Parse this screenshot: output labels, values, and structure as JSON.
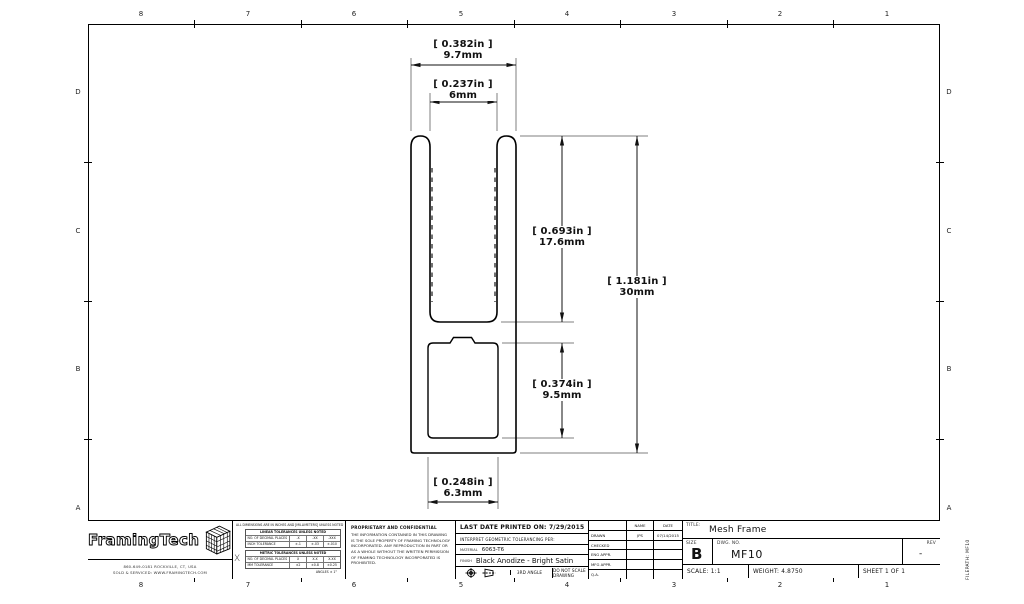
{
  "sheet": {
    "zone_numbers_top": [
      "8",
      "7",
      "6",
      "5",
      "4",
      "3",
      "2",
      "1"
    ],
    "zone_numbers_bottom": [
      "8",
      "7",
      "6",
      "5",
      "4",
      "3",
      "2",
      "1"
    ],
    "zone_letters_left": [
      "D",
      "C",
      "B",
      "A"
    ],
    "zone_letters_right": [
      "D",
      "C",
      "B",
      "A"
    ],
    "filepath_label": "FILEPATH: MF10"
  },
  "dimensions": {
    "outer_width_in": "[ 0.382in ]",
    "outer_width_mm": "9.7mm",
    "slot_width_in": "[ 0.237in ]",
    "slot_width_mm": "6mm",
    "slot_depth_in": "[ 0.693in ]",
    "slot_depth_mm": "17.6mm",
    "overall_height_in": "[ 1.181in ]",
    "overall_height_mm": "30mm",
    "cavity_height_in": "[ 0.374in ]",
    "cavity_height_mm": "9.5mm",
    "cavity_width_in": "[ 0.248in ]",
    "cavity_width_mm": "6.3mm"
  },
  "title_block": {
    "logo_text": "FramingTech",
    "address_line1": "860-649-0181  ROCKVILLE, CT, USA",
    "address_line2": "SOLD & SERVICED:  WWW.FRAMINGTECH.COM",
    "tol": {
      "note": "ALL DIMENSIONS ARE IN INCHES AND [MILLIMETERS] UNLESS NOTED",
      "t1_header": "LINEAR TOLERANCES UNLESS NOTED",
      "t1_r1c1": "NO. OF DECIMAL PLACES",
      "t1_r1c2": ".X",
      "t1_r1c3": ".XX",
      "t1_r1c4": ".XXX",
      "t1_r2c1": "INCH TOLERANCE",
      "t1_r2c2": "±.1",
      "t1_r2c3": "±.03",
      "t1_r2c4": "±.010",
      "t2_header": "METRIC TOLERANCES UNLESS NOTED",
      "t2_r1c1": "NO. OF DECIMAL PLACES",
      "t2_r1c2": "X",
      "t2_r1c3": "X.X",
      "t2_r1c4": "X.XX",
      "t2_r2c1": "MM TOLERANCE",
      "t2_r2c2": "±2",
      "t2_r2c3": "±0.8",
      "t2_r2c4": "±0.25",
      "angles": "ANGLES ± 1°"
    },
    "proprietary_title": "PROPRIETARY AND CONFIDENTIAL",
    "proprietary_body": "THE INFORMATION CONTAINED IN THIS DRAWING IS THE SOLE PROPERTY OF FRAMING TECHNOLOGY INCORPORATED. ANY REPRODUCTION IN PART OR AS A WHOLE WITHOUT THE WRITTEN PERMISSION OF FRAMING TECHNOLOGY INCORPORATED IS PROHIBITED.",
    "print_info": "LAST DATE PRINTED ON: 7/29/2015",
    "interpret": "INTERPRET GEOMETRIC TOLERANCING PER:",
    "material_label": "MATERIAL",
    "material_value": "6063-T6",
    "finish_label": "FINISH",
    "finish_value": "Black Anodize - Bright Satin",
    "projection_label": "3RD ANGLE",
    "do_not_scale": "DO NOT SCALE DRAWING",
    "approvals": {
      "name_header": "NAME",
      "date_header": "DATE",
      "rows": [
        {
          "label": "DRAWN",
          "name": "JPS",
          "date": "07/14/2015"
        },
        {
          "label": "CHECKED",
          "name": "",
          "date": ""
        },
        {
          "label": "ENG APPR.",
          "name": "",
          "date": ""
        },
        {
          "label": "MFG APPR.",
          "name": "",
          "date": ""
        },
        {
          "label": "Q.A.",
          "name": "",
          "date": ""
        }
      ]
    },
    "title_label": "TITLE:",
    "title_value": "Mesh Frame",
    "size_label": "SIZE",
    "size_value": "B",
    "dwg_label": "DWG. NO.",
    "dwg_value": "MF10",
    "rev_label": "REV",
    "rev_value": "-",
    "scale_text": "SCALE: 1:1",
    "weight_text": "WEIGHT: 4.8750",
    "sheet_text": "SHEET 1 OF 1"
  }
}
